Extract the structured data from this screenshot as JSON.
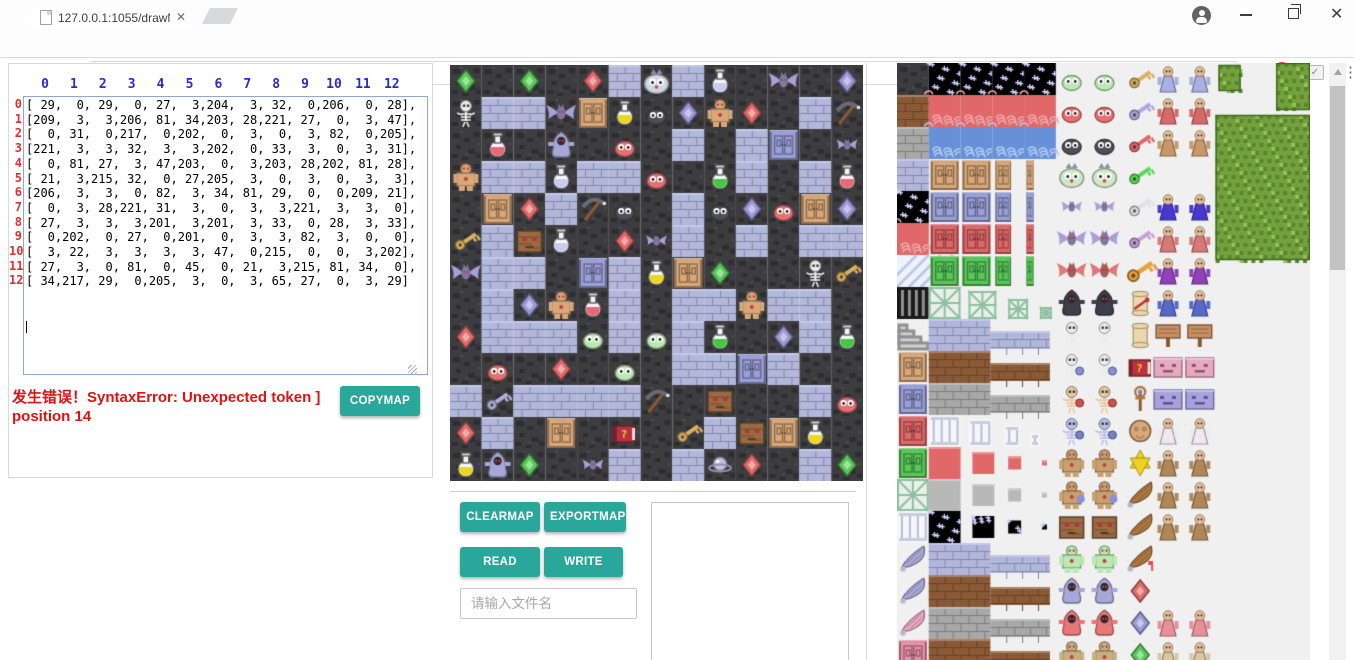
{
  "browser": {
    "tab_title": "127.0.0.1:1055/drawMa",
    "url": "127.0.0.1:1055/drawMapGUI.html"
  },
  "editor": {
    "col_headers": [
      "0",
      "1",
      "2",
      "3",
      "4",
      "5",
      "6",
      "7",
      "8",
      "9",
      "10",
      "11",
      "12"
    ],
    "row_headers": [
      "0",
      "1",
      "2",
      "3",
      "4",
      "5",
      "6",
      "7",
      "8",
      "9",
      "10",
      "11",
      "12"
    ],
    "value": "[ 29,  0, 29,  0, 27,  3,204,  3, 32,  0,206,  0, 28],\n[209,  3,  3,206, 81, 34,203, 28,221, 27,  0,  3, 47],\n[  0, 31,  0,217,  0,202,  0,  3,  0,  3, 82,  0,205],\n[221,  3,  3, 32,  3,  3,202,  0, 33,  3,  0,  3, 31],\n[  0, 81, 27,  3, 47,203,  0,  3,203, 28,202, 81, 28],\n[ 21,  3,215, 32,  0, 27,205,  3,  0,  3,  0,  3,  3],\n[206,  3,  3,  0, 82,  3, 34, 81, 29,  0,  0,209, 21],\n[  0,  3, 28,221, 31,  3,  0,  3,  3,221,  3,  3,  0],\n[ 27,  3,  3,  3,201,  3,201,  3, 33,  0, 28,  3, 33],\n[  0,202,  0, 27,  0,201,  0,  3,  3, 82,  3,  0,  0],\n[  3, 22,  3,  3,  3,  3, 47,  0,215,  0,  0,  3,202],\n[ 27,  3,  0, 81,  0, 45,  0, 21,  3,215, 81, 34,  0],\n[ 34,217, 29,  0,205,  3,  0,  3, 65, 27,  0,  3, 29]\n"
  },
  "error": {
    "text": "发生错误！SyntaxError: Unexpected token ] position 14"
  },
  "buttons": {
    "copymap": "COPYMAP",
    "clearmap": "CLEARMAP",
    "exportmap": "EXPORTMAP",
    "read": "READ",
    "write": "WRITE"
  },
  "file_input": {
    "placeholder": "请输入文件名",
    "value": ""
  },
  "colors": {
    "accent": "#2aa79b",
    "error_red": "#e01212",
    "header_blue": "#2a2ad0",
    "header_red": "#e03030"
  },
  "map": {
    "grid_size": 13,
    "matrix": [
      [
        29,
        0,
        29,
        0,
        27,
        3,
        204,
        3,
        32,
        0,
        206,
        0,
        28
      ],
      [
        209,
        3,
        3,
        206,
        81,
        34,
        203,
        28,
        221,
        27,
        0,
        3,
        47
      ],
      [
        0,
        31,
        0,
        217,
        0,
        202,
        0,
        3,
        0,
        3,
        82,
        0,
        205
      ],
      [
        221,
        3,
        3,
        32,
        3,
        3,
        202,
        0,
        33,
        3,
        0,
        3,
        31
      ],
      [
        0,
        81,
        27,
        3,
        47,
        203,
        0,
        3,
        203,
        28,
        202,
        81,
        28
      ],
      [
        21,
        3,
        215,
        32,
        0,
        27,
        205,
        3,
        0,
        3,
        0,
        3,
        3
      ],
      [
        206,
        3,
        3,
        0,
        82,
        3,
        34,
        81,
        29,
        0,
        0,
        209,
        21
      ],
      [
        0,
        3,
        28,
        221,
        31,
        3,
        0,
        3,
        3,
        221,
        3,
        3,
        0
      ],
      [
        27,
        3,
        3,
        3,
        201,
        3,
        201,
        3,
        33,
        0,
        28,
        3,
        33
      ],
      [
        0,
        202,
        0,
        27,
        0,
        201,
        0,
        3,
        3,
        82,
        3,
        0,
        0
      ],
      [
        3,
        22,
        3,
        3,
        3,
        3,
        47,
        0,
        215,
        0,
        0,
        3,
        202
      ],
      [
        27,
        3,
        0,
        81,
        0,
        45,
        0,
        21,
        3,
        215,
        81,
        34,
        0
      ],
      [
        34,
        217,
        29,
        0,
        205,
        3,
        0,
        3,
        65,
        27,
        0,
        3,
        29
      ]
    ],
    "legend": {
      "0": {
        "kind": "wall",
        "name": "dark-ground"
      },
      "3": {
        "kind": "floor",
        "name": "stone-floor"
      },
      "21": {
        "kind": "key",
        "color": "#d8b060",
        "name": "yellow-key"
      },
      "22": {
        "kind": "key",
        "color": "#b0b0d8",
        "name": "blue-key"
      },
      "27": {
        "kind": "gem",
        "color": "#e06a6a",
        "name": "red-gem"
      },
      "28": {
        "kind": "gem",
        "color": "#9a9ad8",
        "name": "blue-gem"
      },
      "29": {
        "kind": "gem",
        "color": "#58c858",
        "name": "green-gem"
      },
      "31": {
        "kind": "potion",
        "color": "#e86878",
        "name": "red-potion"
      },
      "32": {
        "kind": "potion",
        "color": "#c8ccf0",
        "name": "blue-potion"
      },
      "33": {
        "kind": "potion",
        "color": "#44c844",
        "name": "green-potion"
      },
      "34": {
        "kind": "potion",
        "color": "#e8d820",
        "name": "yellow-potion"
      },
      "45": {
        "kind": "book",
        "color": "#b83244",
        "name": "monster-manual"
      },
      "47": {
        "kind": "pickaxe",
        "color": "#8a5a32",
        "name": "pickaxe"
      },
      "65": {
        "kind": "orb",
        "color": "#c4c4da",
        "name": "silver-orb"
      },
      "81": {
        "kind": "door",
        "color": "#d8a878",
        "name": "yellow-door"
      },
      "82": {
        "kind": "door",
        "color": "#9aa0d8",
        "name": "blue-door"
      },
      "201": {
        "kind": "slime",
        "color": "#bce8b4",
        "name": "green-slime"
      },
      "202": {
        "kind": "slime",
        "color": "#e87070",
        "name": "red-slime"
      },
      "203": {
        "kind": "slime",
        "color": "#4e4e58",
        "name": "black-slime"
      },
      "204": {
        "kind": "bigslime",
        "color": "#cfd8e0",
        "name": "big-slime"
      },
      "205": {
        "kind": "bat",
        "color": "#a8a0d8",
        "small": true,
        "name": "small-bat"
      },
      "206": {
        "kind": "bat",
        "color": "#a8a0d8",
        "name": "big-bat"
      },
      "209": {
        "kind": "skeleton",
        "color": "#ececec",
        "name": "skeleton"
      },
      "215": {
        "kind": "rock",
        "color": "#9a6a42",
        "name": "rock-monster"
      },
      "217": {
        "kind": "ghost",
        "color": "#a8a8d8",
        "name": "ghost"
      },
      "221": {
        "kind": "golem",
        "color": "#d8a878",
        "name": "golem"
      }
    }
  },
  "tileset": {
    "terrain_column": [
      {
        "tex": "dark"
      },
      {
        "tex": "dirt"
      },
      {
        "tex": "stone"
      },
      {
        "tex": "brick"
      },
      {
        "tex": "stars"
      },
      {
        "tex": "lava"
      },
      {
        "tex": "stripes"
      },
      {
        "tex": "grill"
      },
      {
        "tex": "stairs"
      },
      {
        "tex": "door",
        "color": "#d8a878"
      },
      {
        "tex": "door",
        "color": "#9aa0d8"
      },
      {
        "tex": "door",
        "color": "#e06868"
      },
      {
        "tex": "door",
        "color": "#58c858"
      },
      {
        "tex": "lattice"
      },
      {
        "tex": "pillar"
      },
      {
        "tex": "wing"
      },
      {
        "tex": "wing"
      },
      {
        "tex": "wingpink"
      },
      {
        "tex": "door",
        "color": "#e890a8"
      }
    ],
    "bands": [
      "stars",
      "lava",
      "water"
    ],
    "door_anim_rows": [
      "#d8a878",
      "#9aa0d8",
      "#e06868",
      "#58c858"
    ],
    "lattice_row": 7,
    "strip_rows": [
      {
        "row": 8,
        "color": "#b2b6dc"
      },
      {
        "row": 9,
        "color": "#8a5a36"
      },
      {
        "row": 10,
        "color": "#a8a8a8"
      },
      {
        "row": 15,
        "color": "#b2b6dc"
      },
      {
        "row": 16,
        "color": "#8a5a36"
      },
      {
        "row": 17,
        "color": "#a8a8a8"
      },
      {
        "row": 18,
        "color": "#8a5a36"
      }
    ],
    "pillar_row": 11,
    "shrink_rows": [
      {
        "row": 12,
        "color": "#e06868"
      },
      {
        "row": 13,
        "color": "#b8b8b8"
      },
      {
        "row": 14,
        "color": "#111118"
      }
    ],
    "monster_rows": [
      {
        "kind": "slime",
        "color": "#bce8b4",
        "name": "green-slime"
      },
      {
        "kind": "slime",
        "color": "#e87070",
        "name": "red-slime"
      },
      {
        "kind": "slime",
        "color": "#4e4e58",
        "name": "black-slime"
      },
      {
        "kind": "bigslime",
        "color": "#cfe8c8",
        "name": "big-slime"
      },
      {
        "kind": "bat",
        "color": "#a8a0d8",
        "small": true,
        "name": "small-bat"
      },
      {
        "kind": "bat",
        "color": "#a8a0d8",
        "name": "big-bat"
      },
      {
        "kind": "bat",
        "color": "#e07878",
        "name": "red-bat"
      },
      {
        "kind": "ghost",
        "color": "#3e3e4a",
        "name": "vampire"
      },
      {
        "kind": "skeleton",
        "color": "#ececec",
        "name": "skeleton"
      },
      {
        "kind": "skeleton",
        "color": "#ececec",
        "shield": "#8890d8",
        "name": "skeleton-soldier"
      },
      {
        "kind": "skeleton",
        "color": "#e8c8a0",
        "shield": "#d05050",
        "name": "skeleton-warrior"
      },
      {
        "kind": "skeleton",
        "color": "#b8c0e8",
        "shield": "#7880c8",
        "name": "skeleton-knight"
      },
      {
        "kind": "golem",
        "color": "#c8a070",
        "name": "zombie"
      },
      {
        "kind": "golem",
        "color": "#c8a070",
        "shield": "#8890d8",
        "name": "zombie-knight"
      },
      {
        "kind": "rock",
        "color": "#9a6a42",
        "name": "rock-monster"
      },
      {
        "kind": "golem",
        "color": "#bce8b4",
        "name": "slime-man"
      },
      {
        "kind": "ghost",
        "color": "#a8a8d8",
        "name": "purple-ghost"
      },
      {
        "kind": "ghost",
        "color": "#e87878",
        "name": "red-ghost"
      },
      {
        "kind": "golem",
        "color": "#c8b080",
        "name": "swordsman"
      }
    ],
    "item_rows": [
      {
        "kind": "key",
        "color": "#d8b060",
        "name": "yellow-key"
      },
      {
        "kind": "key",
        "color": "#a8a8e0",
        "name": "blue-key"
      },
      {
        "kind": "key",
        "color": "#e06868",
        "name": "red-key"
      },
      {
        "kind": "key",
        "color": "#58d858",
        "name": "green-key"
      },
      {
        "kind": "key",
        "color": "#e0e0e8",
        "name": "steel-key"
      },
      {
        "kind": "key",
        "color": "#c8a0d8",
        "name": "purple-key"
      },
      {
        "kind": "key",
        "color": "#e8a040",
        "big": true,
        "name": "big-key"
      },
      {
        "kind": "scroll",
        "color": "#ead8b0",
        "ribbon": "#c03030",
        "name": "sealed-scroll"
      },
      {
        "kind": "scroll",
        "color": "#ead8b0",
        "name": "scroll"
      },
      {
        "kind": "book",
        "color": "#b83244",
        "name": "monster-manual"
      },
      {
        "kind": "scepter",
        "color": "#b07840",
        "name": "scepter"
      },
      {
        "kind": "medal",
        "color": "#d8a878",
        "name": "medal"
      },
      {
        "kind": "star",
        "color": "#f0d020",
        "name": "hexagram"
      },
      {
        "kind": "wing",
        "color": "#b07840",
        "name": "wing-1"
      },
      {
        "kind": "wing",
        "color": "#b07840",
        "name": "wing-2"
      },
      {
        "kind": "wing",
        "color": "#b07840",
        "flag": "#e05050",
        "name": "wing-flag"
      },
      {
        "kind": "gem",
        "color": "#e06a6a",
        "name": "red-gem"
      },
      {
        "kind": "gem",
        "color": "#9a9ad8",
        "name": "blue-gem"
      },
      {
        "kind": "gem",
        "color": "#58c858",
        "name": "green-gem"
      }
    ],
    "npc_rows": [
      {
        "kind": "npc",
        "robe": "#a8b0e0",
        "name": "elder"
      },
      {
        "kind": "npc",
        "robe": "#d86868",
        "name": "monk"
      },
      {
        "kind": "npc",
        "robe": "#c89868",
        "name": "fighter"
      },
      {
        "kind": "fairy",
        "robe": "#e8a0c0",
        "name": "fairy"
      },
      {
        "kind": "npc",
        "robe": "#4838d0",
        "name": "wizard"
      },
      {
        "kind": "npc",
        "robe": "#d87878",
        "name": "dark-priest"
      },
      {
        "kind": "npc",
        "robe": "#9040b8",
        "name": "king"
      },
      {
        "kind": "npc",
        "robe": "#5868c8",
        "name": "hero"
      },
      {
        "kind": "sign",
        "robe": "#c89060",
        "name": "wood-sign"
      },
      {
        "kind": "counter",
        "robe": "#e8a8c0",
        "name": "pink-counter"
      },
      {
        "kind": "counter",
        "robe": "#a8a0e0",
        "name": "purple-counter"
      },
      {
        "kind": "npc",
        "robe": "#f0e8f0",
        "name": "princess"
      },
      {
        "kind": "npc",
        "robe": "#b08858",
        "name": "villager-1"
      },
      {
        "kind": "npc",
        "robe": "#b08858",
        "name": "villager-2"
      },
      {
        "kind": "npc",
        "robe": "#b08858",
        "name": "villager-3"
      },
      {
        "kind": "fairy",
        "robe": "#e8b0c8",
        "name": "angel-1"
      },
      {
        "kind": "fairy",
        "robe": "#e8b0c8",
        "name": "angel-2"
      },
      {
        "kind": "npc",
        "robe": "#e89098",
        "name": "pink-monster"
      },
      {
        "kind": "npc",
        "robe": "#d8c8a0",
        "name": "merchant"
      }
    ]
  }
}
